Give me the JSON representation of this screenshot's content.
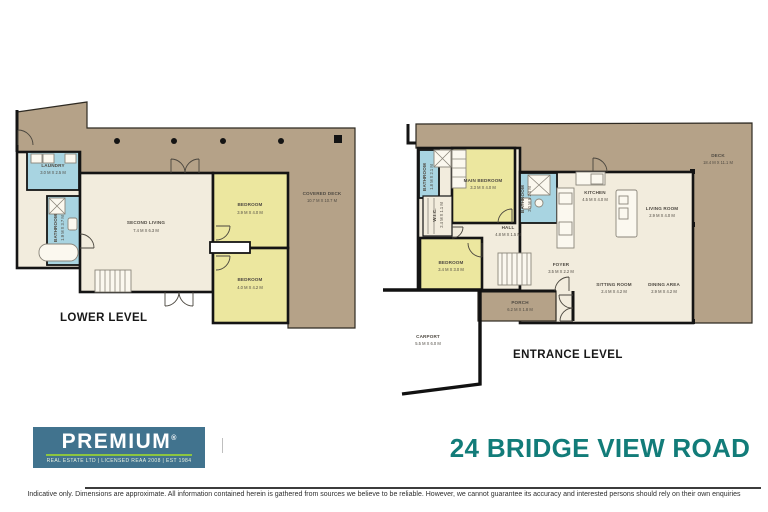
{
  "title": "24 BRIDGE VIEW ROAD",
  "logo": {
    "brand": "PREMIUM",
    "reg": "®",
    "tagline": "REAL ESTATE LTD | LICENSED REAA 2008 | EST 1984"
  },
  "disclaimer": "Indicative only. Dimensions are approximate. All information contained herein is gathered from sources we believe to be reliable. However, we cannot guarantee its accuracy and interested persons should rely on their own enquiries",
  "colors": {
    "deck": "#b5a288",
    "floor": "#f2ecdd",
    "bedroom_yellow": "#ece79f",
    "bathroom_blue": "#a8d4e1",
    "wall": "#141414",
    "logo_blue": "#41738e",
    "logo_green": "#8cc540",
    "title_teal": "#127c79"
  },
  "lower": {
    "label": "LOWER LEVEL",
    "laundry": {
      "name": "LAUNDRY",
      "dims": "3.0 M X 2.5 M"
    },
    "bathroom": {
      "name": "BATHROOM",
      "dims": "1.9 M X 3.7 M"
    },
    "second_living": {
      "name": "SECOND LIVING",
      "dims": "7.4 M X 6.3 M"
    },
    "bedroom1": {
      "name": "BEDROOM",
      "dims": "3.9 M X 4.0 M"
    },
    "bedroom2": {
      "name": "BEDROOM",
      "dims": "4.0 M X 4.2 M"
    },
    "covered_deck": {
      "name": "COVERED DECK",
      "dims": "10.7 M X 10.7 M"
    }
  },
  "entrance": {
    "label": "ENTRANCE LEVEL",
    "bathroom1": {
      "name": "BATHROOM",
      "dims": "1.8 M X 2.1 M"
    },
    "main_bedroom": {
      "name": "MAIN BEDROOM",
      "dims": "3.3 M X 4.0 M"
    },
    "wic": {
      "name": "W.I.C.",
      "dims": "2.4 M X 1.1 M"
    },
    "bathroom2": {
      "name": "BATHROOM",
      "dims": "2.0 M X 2.0 M"
    },
    "bedroom": {
      "name": "BEDROOM",
      "dims": "3.4 M X 3.0 M"
    },
    "hall": {
      "name": "HALL",
      "dims": "4.8 M X 1.5 M"
    },
    "kitchen": {
      "name": "KITCHEN",
      "dims": "4.5 M X 4.0 M"
    },
    "living_room": {
      "name": "LIVING ROOM",
      "dims": "2.9 M X 4.0 M"
    },
    "foyer": {
      "name": "FOYER",
      "dims": "3.5 M X 2.2 M"
    },
    "sitting_room": {
      "name": "SITTING ROOM",
      "dims": "2.4 M X 4.2 M"
    },
    "dining_area": {
      "name": "DINING AREA",
      "dims": "2.9 M X 4.2 M"
    },
    "porch": {
      "name": "PORCH",
      "dims": "6.2 M X 1.8 M"
    },
    "carport": {
      "name": "CARPORT",
      "dims": "5.5 M X 6.0 M"
    },
    "deck": {
      "name": "DECK",
      "dims": "18.4 M X 11.1 M"
    }
  }
}
